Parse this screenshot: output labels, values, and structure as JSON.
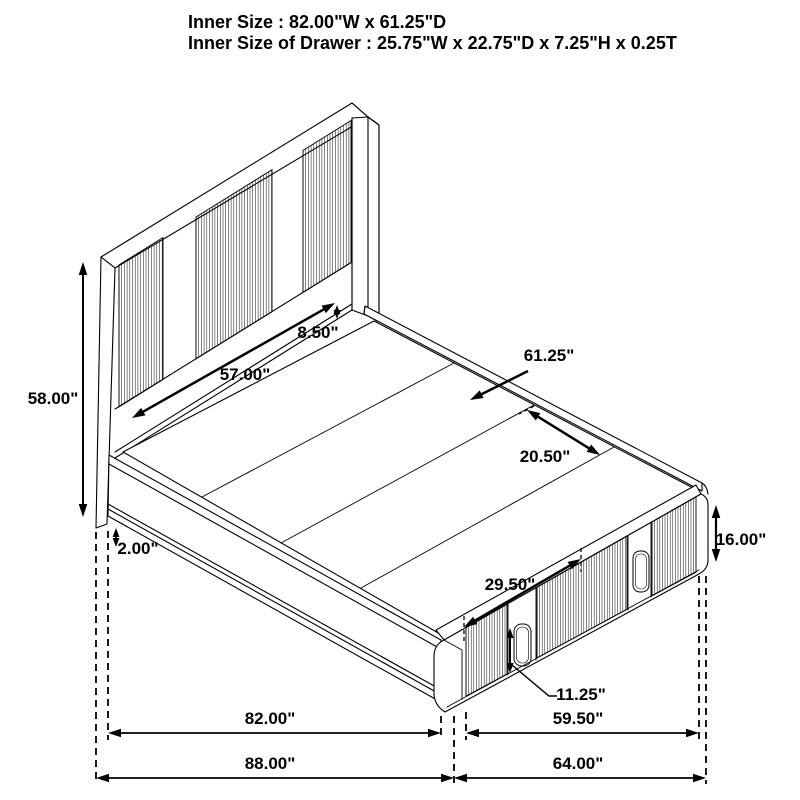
{
  "title": {
    "line1": "Inner Size : 82.00\"W x 61.25\"D",
    "line2": "Inner Size of Drawer : 25.75\"W x 22.75\"D x 7.25\"H x 0.25T"
  },
  "dimensions": {
    "headboard_height": "58.00\"",
    "headboard_rail_height": "8.50\"",
    "headboard_panel_width": "57.00\"",
    "mattress_depth": "61.25\"",
    "slat_spacing": "20.50\"",
    "rail_floor_gap": "2.00\"",
    "footboard_height": "16.00\"",
    "drawer_span": "29.50\"",
    "drawer_front_height": "11.25\"",
    "inner_length": "82.00\"",
    "footboard_inner_width": "59.50\"",
    "overall_length": "88.00\"",
    "overall_width": "64.00\""
  }
}
